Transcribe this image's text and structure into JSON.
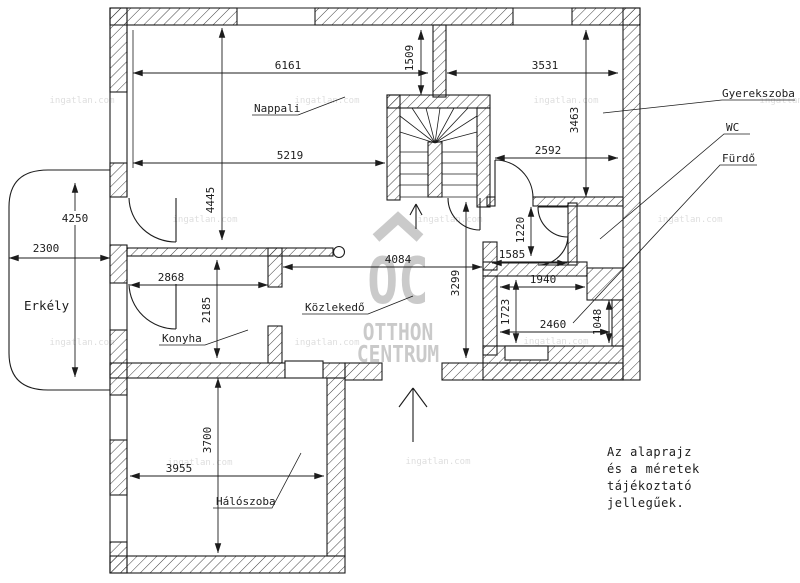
{
  "rooms": {
    "living": "Nappali",
    "kids": "Gyerekszoba",
    "wc": "WC",
    "bath": "Fürdő",
    "balcony": "Erkély",
    "kitchen": "Konyha",
    "hall": "Közlekedő",
    "bedroom": "Hálószoba"
  },
  "dims": {
    "living_top": "6161",
    "entry_stub": "1509",
    "kids_top": "3531",
    "kids_right": "3463",
    "living_mid": "5219",
    "kids_bottom": "2592",
    "living_left": "4445",
    "balcony_height": "4250",
    "balcony_width": "2300",
    "kitchen_top": "2868",
    "kitchen_left": "2185",
    "hall_top": "4084",
    "hall_right": "3299",
    "wc_left": "1220",
    "wc_top": "1585",
    "bath_top": "1940",
    "bath_left": "1723",
    "bath_bottom": "2460",
    "bath_right": "1048",
    "bedroom_left": "3700",
    "bedroom_bottom": "3955"
  },
  "note": {
    "lines": [
      "Az alaprajz",
      "és a méretek",
      "tájékoztató",
      "jellegűek."
    ]
  },
  "watermark": {
    "logo": "OC",
    "brand_top": "OTTHON",
    "brand_bottom": "CENTRUM",
    "site": "ingatlan.com"
  },
  "colors": {
    "line": "#1c1c1c",
    "watermark": "#bdbdbd"
  }
}
